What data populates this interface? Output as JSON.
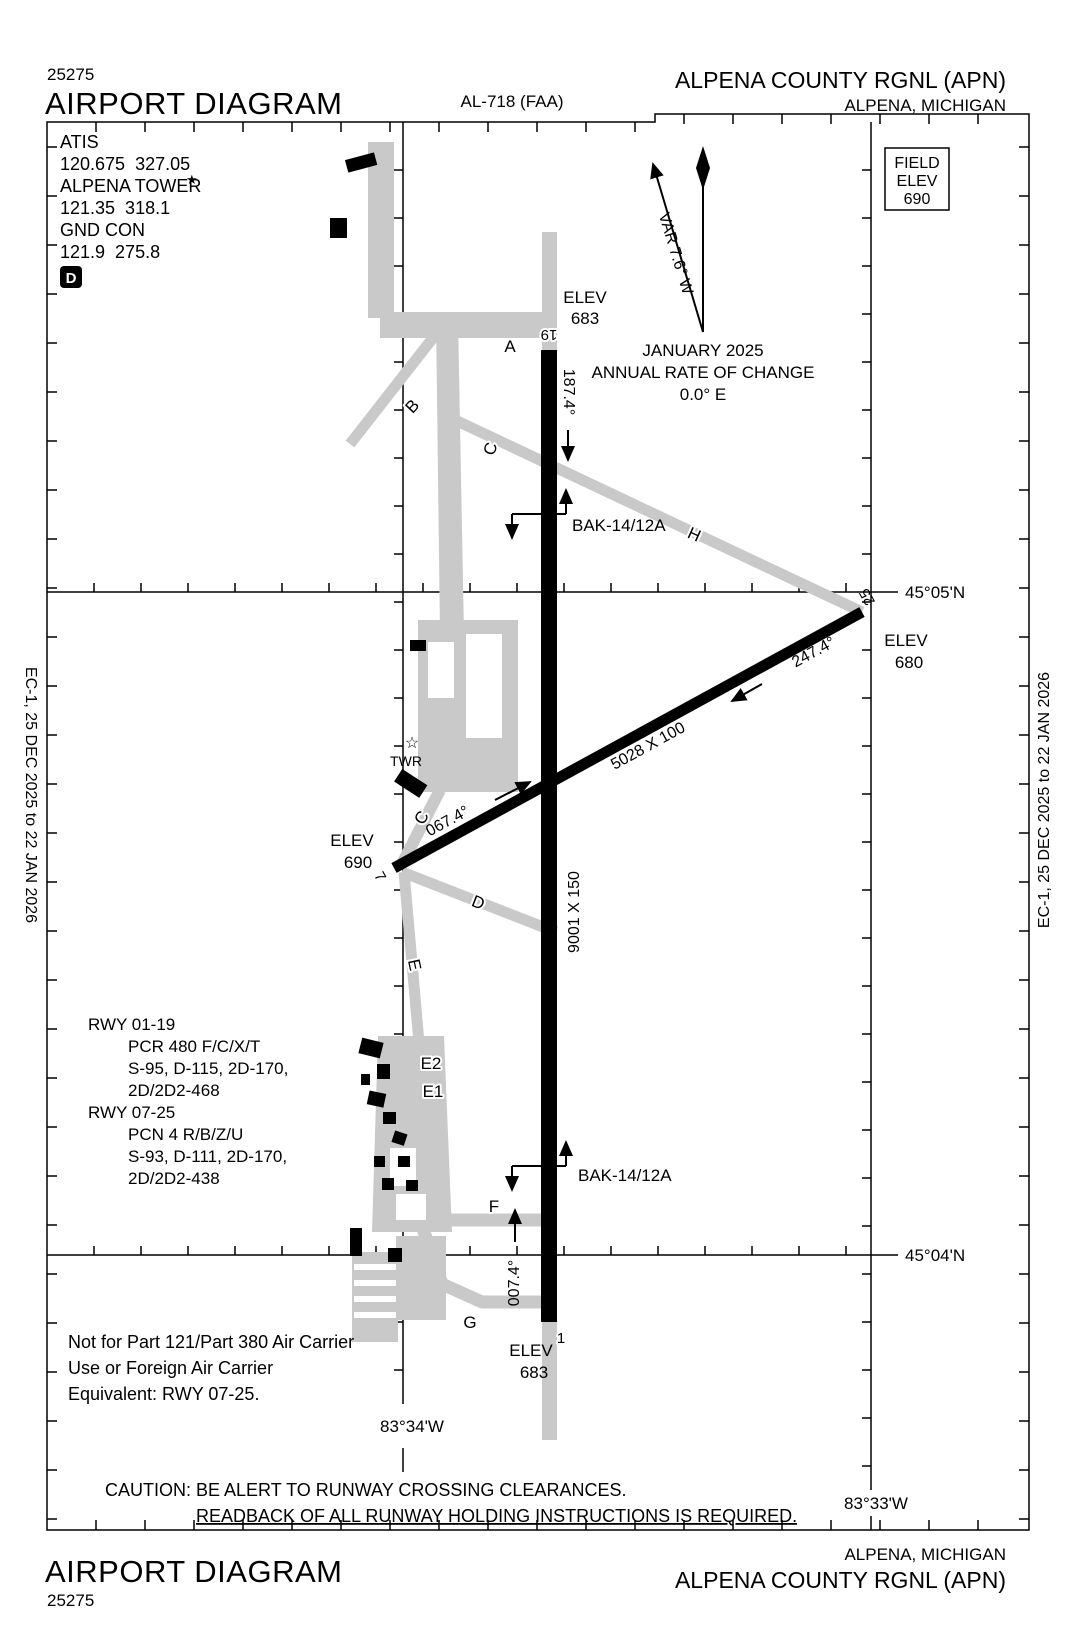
{
  "header": {
    "chart_number": "25275",
    "title": "AIRPORT DIAGRAM",
    "procedure_id": "AL-718 (FAA)",
    "airport": "ALPENA COUNTY RGNL (APN)",
    "city": "ALPENA, MICHIGAN"
  },
  "footer": {
    "title": "AIRPORT DIAGRAM",
    "chart_number": "25275",
    "airport": "ALPENA COUNTY RGNL (APN)",
    "city": "ALPENA, MICHIGAN"
  },
  "edition": {
    "left": "EC-1, 25 DEC 2025 to 22 JAN 2026",
    "right": "EC-1, 25 DEC 2025 to 22 JAN 2026"
  },
  "comms": {
    "atis_label": "ATIS",
    "atis_freqs": "120.675  327.05",
    "tower_label": "ALPENA TOWER",
    "tower_star": "★",
    "tower_freqs": "121.35  318.1",
    "ground_label": "GND CON",
    "ground_freqs": "121.9  275.8",
    "notam_d": "D"
  },
  "field_elevation": {
    "line1": "FIELD",
    "line2": "ELEV",
    "value": "690"
  },
  "compass": {
    "variation": "VAR 7.6° W",
    "date": "JANUARY 2025",
    "rate_label": "ANNUAL RATE OF CHANGE",
    "rate_value": "0.0° E"
  },
  "grid": {
    "lat_north": "45°05'N",
    "lat_south": "45°04'N",
    "lon_west": "83°34'W",
    "lon_east": "83°33'W"
  },
  "runway_01_19": {
    "number_north": "19",
    "number_south": "1",
    "size": "9001 X 150",
    "heading_south": "187.4°",
    "heading_north": "007.4°",
    "elev_north_label": "ELEV",
    "elev_north": "683",
    "elev_south_label": "ELEV",
    "elev_south": "683",
    "arresting_gear_north": "BAK-14/12A",
    "arresting_gear_south": "BAK-14/12A"
  },
  "runway_07_25": {
    "number_west": "7",
    "number_east": "25",
    "size": "5028 X 100",
    "heading_east": "067.4°",
    "heading_west": "247.4°",
    "elev_west_label": "ELEV",
    "elev_west": "690",
    "elev_east_label": "ELEV",
    "elev_east": "680"
  },
  "tower": {
    "star": "☆",
    "label": "TWR"
  },
  "taxiways": {
    "a": "A",
    "b": "B",
    "c_north": "C",
    "h": "H",
    "c_south": "C",
    "d": "D",
    "e": "E",
    "e2": "E2",
    "e1": "E1",
    "f": "F",
    "g": "G"
  },
  "runway_data": {
    "rwy_01_19_label": "RWY 01-19",
    "rwy_01_19_lines": [
      "PCR 480 F/C/X/T",
      "S-95, D-115, 2D-170,",
      "2D/2D2-468"
    ],
    "rwy_07_25_label": "RWY 07-25",
    "rwy_07_25_lines": [
      "PCN 4 R/B/Z/U",
      "S-93, D-111, 2D-170,",
      "2D/2D2-438"
    ]
  },
  "notes": {
    "restriction_lines": [
      "Not for Part 121/Part 380 Air Carrier",
      "Use or Foreign Air Carrier",
      "Equivalent: RWY 07-25."
    ],
    "caution": "CAUTION: BE ALERT TO RUNWAY CROSSING CLEARANCES.",
    "readback": "READBACK OF ALL RUNWAY HOLDING INSTRUCTIONS IS REQUIRED."
  },
  "colors": {
    "ink": "#000000",
    "taxiway_gray": "#c9c9c9"
  }
}
